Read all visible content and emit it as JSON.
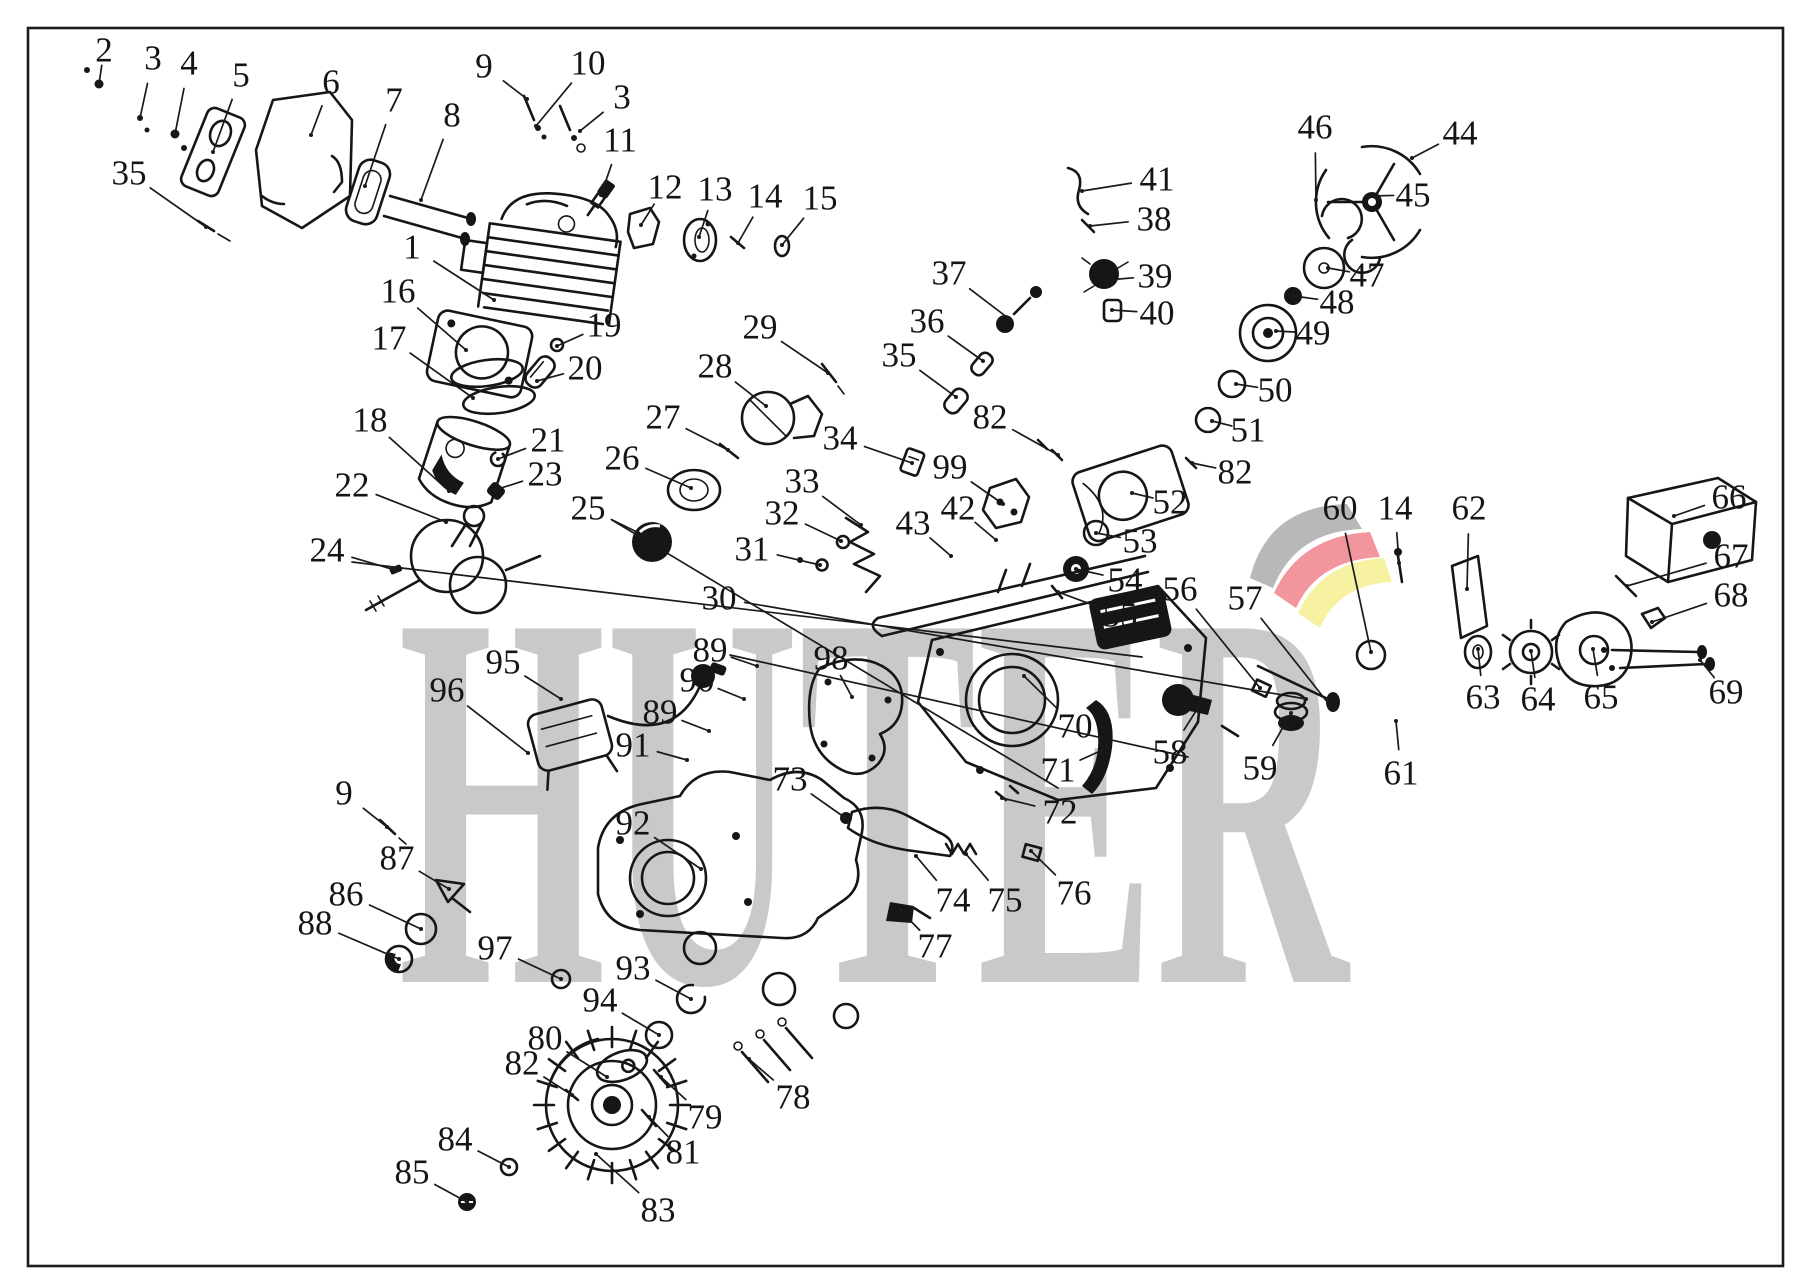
{
  "canvas": {
    "width": 1809,
    "height": 1283,
    "background": "#ffffff",
    "border_color": "#1c1c1c"
  },
  "watermark": {
    "text": "HUTER",
    "color": "#c9c9c9",
    "logo_colors": {
      "gray": "#b8b8b8",
      "red": "#f2959d",
      "yellow": "#f6f2a2"
    }
  },
  "extra_leader_lines": [
    [
      352,
      562,
      1142,
      657
    ],
    [
      612,
      520,
      1058,
      788
    ],
    [
      730,
      655,
      1188,
      757
    ]
  ],
  "callouts": [
    {
      "n": "2",
      "x": 104,
      "y": 50,
      "tx": 99,
      "ty": 84
    },
    {
      "n": "3",
      "x": 153,
      "y": 58,
      "tx": 140,
      "ty": 118
    },
    {
      "n": "4",
      "x": 189,
      "y": 63,
      "tx": 175,
      "ty": 134
    },
    {
      "n": "5",
      "x": 241,
      "y": 75,
      "tx": 213,
      "ty": 152
    },
    {
      "n": "6",
      "x": 331,
      "y": 82,
      "tx": 311,
      "ty": 135
    },
    {
      "n": "7",
      "x": 394,
      "y": 100,
      "tx": 365,
      "ty": 186
    },
    {
      "n": "8",
      "x": 452,
      "y": 115,
      "tx": 421,
      "ty": 200
    },
    {
      "n": "9",
      "x": 484,
      "y": 66,
      "tx": 527,
      "ty": 99
    },
    {
      "n": "10",
      "x": 588,
      "y": 63,
      "tx": 536,
      "ty": 126
    },
    {
      "n": "3",
      "x": 622,
      "y": 97,
      "tx": 580,
      "ty": 131
    },
    {
      "n": "35",
      "x": 129,
      "y": 173,
      "tx": 206,
      "ty": 227
    },
    {
      "n": "11",
      "x": 620,
      "y": 140,
      "tx": 601,
      "ty": 195
    },
    {
      "n": "12",
      "x": 665,
      "y": 187,
      "tx": 641,
      "ty": 225
    },
    {
      "n": "13",
      "x": 715,
      "y": 189,
      "tx": 699,
      "ty": 237
    },
    {
      "n": "14",
      "x": 765,
      "y": 196,
      "tx": 738,
      "ty": 243
    },
    {
      "n": "15",
      "x": 820,
      "y": 198,
      "tx": 782,
      "ty": 245
    },
    {
      "n": "1",
      "x": 412,
      "y": 247,
      "tx": 494,
      "ty": 300
    },
    {
      "n": "16",
      "x": 398,
      "y": 291,
      "tx": 466,
      "ty": 350
    },
    {
      "n": "17",
      "x": 389,
      "y": 338,
      "tx": 473,
      "ty": 398
    },
    {
      "n": "19",
      "x": 604,
      "y": 325,
      "tx": 557,
      "ty": 346
    },
    {
      "n": "20",
      "x": 585,
      "y": 368,
      "tx": 537,
      "ty": 381
    },
    {
      "n": "18",
      "x": 370,
      "y": 420,
      "tx": 449,
      "ty": 491
    },
    {
      "n": "21",
      "x": 548,
      "y": 440,
      "tx": 498,
      "ty": 459
    },
    {
      "n": "22",
      "x": 352,
      "y": 485,
      "tx": 446,
      "ty": 522
    },
    {
      "n": "23",
      "x": 545,
      "y": 474,
      "tx": 495,
      "ty": 490
    },
    {
      "n": "24",
      "x": 327,
      "y": 550,
      "tx": 395,
      "ty": 570
    },
    {
      "n": "25",
      "x": 588,
      "y": 508,
      "tx": 645,
      "ty": 536
    },
    {
      "n": "26",
      "x": 622,
      "y": 458,
      "tx": 691,
      "ty": 488
    },
    {
      "n": "27",
      "x": 663,
      "y": 417,
      "tx": 728,
      "ty": 450
    },
    {
      "n": "28",
      "x": 715,
      "y": 366,
      "tx": 766,
      "ty": 406
    },
    {
      "n": "29",
      "x": 760,
      "y": 327,
      "tx": 828,
      "ty": 373
    },
    {
      "n": "30",
      "x": 719,
      "y": 598,
      "tx": 1306,
      "ty": 699
    },
    {
      "n": "31",
      "x": 752,
      "y": 549,
      "tx": 820,
      "ty": 565
    },
    {
      "n": "32",
      "x": 782,
      "y": 513,
      "tx": 841,
      "ty": 541
    },
    {
      "n": "33",
      "x": 802,
      "y": 481,
      "tx": 861,
      "ty": 525
    },
    {
      "n": "34",
      "x": 840,
      "y": 438,
      "tx": 912,
      "ty": 463
    },
    {
      "n": "42",
      "x": 958,
      "y": 508,
      "tx": 996,
      "ty": 540
    },
    {
      "n": "43",
      "x": 913,
      "y": 523,
      "tx": 951,
      "ty": 556
    },
    {
      "n": "35",
      "x": 899,
      "y": 355,
      "tx": 956,
      "ty": 397
    },
    {
      "n": "36",
      "x": 927,
      "y": 321,
      "tx": 983,
      "ty": 361
    },
    {
      "n": "37",
      "x": 949,
      "y": 273,
      "tx": 1008,
      "ty": 318
    },
    {
      "n": "41",
      "x": 1157,
      "y": 179,
      "tx": 1082,
      "ty": 191
    },
    {
      "n": "38",
      "x": 1154,
      "y": 219,
      "tx": 1090,
      "ty": 226
    },
    {
      "n": "39",
      "x": 1155,
      "y": 276,
      "tx": 1107,
      "ty": 280
    },
    {
      "n": "40",
      "x": 1157,
      "y": 313,
      "tx": 1112,
      "ty": 310
    },
    {
      "n": "82",
      "x": 990,
      "y": 417,
      "tx": 1058,
      "ty": 455
    },
    {
      "n": "99",
      "x": 950,
      "y": 467,
      "tx": 1003,
      "ty": 504
    },
    {
      "n": "46",
      "x": 1315,
      "y": 127,
      "tx": 1316,
      "ty": 200
    },
    {
      "n": "44",
      "x": 1460,
      "y": 133,
      "tx": 1412,
      "ty": 158
    },
    {
      "n": "45",
      "x": 1413,
      "y": 195,
      "tx": 1370,
      "ty": 196
    },
    {
      "n": "47",
      "x": 1367,
      "y": 275,
      "tx": 1328,
      "ty": 268
    },
    {
      "n": "48",
      "x": 1337,
      "y": 302,
      "tx": 1294,
      "ty": 296
    },
    {
      "n": "49",
      "x": 1313,
      "y": 333,
      "tx": 1276,
      "ty": 331
    },
    {
      "n": "50",
      "x": 1275,
      "y": 390,
      "tx": 1236,
      "ty": 384
    },
    {
      "n": "51",
      "x": 1248,
      "y": 430,
      "tx": 1212,
      "ty": 421
    },
    {
      "n": "82",
      "x": 1235,
      "y": 472,
      "tx": 1192,
      "ty": 463
    },
    {
      "n": "52",
      "x": 1170,
      "y": 502,
      "tx": 1132,
      "ty": 493
    },
    {
      "n": "53",
      "x": 1140,
      "y": 541,
      "tx": 1096,
      "ty": 533
    },
    {
      "n": "54",
      "x": 1125,
      "y": 580,
      "tx": 1076,
      "ty": 569
    },
    {
      "n": "55",
      "x": 1120,
      "y": 615,
      "tx": 1058,
      "ty": 592
    },
    {
      "n": "56",
      "x": 1180,
      "y": 589,
      "tx": 1260,
      "ty": 688
    },
    {
      "n": "57",
      "x": 1245,
      "y": 598,
      "tx": 1328,
      "ty": 703
    },
    {
      "n": "60",
      "x": 1340,
      "y": 508,
      "tx": 1371,
      "ty": 652
    },
    {
      "n": "14",
      "x": 1395,
      "y": 508,
      "tx": 1399,
      "ty": 563
    },
    {
      "n": "62",
      "x": 1469,
      "y": 508,
      "tx": 1467,
      "ty": 589
    },
    {
      "n": "66",
      "x": 1729,
      "y": 497,
      "tx": 1674,
      "ty": 516
    },
    {
      "n": "67",
      "x": 1731,
      "y": 556,
      "tx": 1627,
      "ty": 586
    },
    {
      "n": "68",
      "x": 1731,
      "y": 595,
      "tx": 1652,
      "ty": 622
    },
    {
      "n": "69",
      "x": 1726,
      "y": 692,
      "tx": 1700,
      "ty": 660
    },
    {
      "n": "63",
      "x": 1483,
      "y": 697,
      "tx": 1478,
      "ty": 649
    },
    {
      "n": "64",
      "x": 1538,
      "y": 699,
      "tx": 1531,
      "ty": 651
    },
    {
      "n": "65",
      "x": 1601,
      "y": 697,
      "tx": 1593,
      "ty": 649
    },
    {
      "n": "58",
      "x": 1170,
      "y": 752,
      "tx": 1201,
      "ty": 703
    },
    {
      "n": "59",
      "x": 1260,
      "y": 768,
      "tx": 1291,
      "ty": 713
    },
    {
      "n": "61",
      "x": 1401,
      "y": 773,
      "tx": 1396,
      "ty": 721
    },
    {
      "n": "70",
      "x": 1075,
      "y": 726,
      "tx": 1024,
      "ty": 676
    },
    {
      "n": "71",
      "x": 1058,
      "y": 770,
      "tx": 1107,
      "ty": 748
    },
    {
      "n": "72",
      "x": 1060,
      "y": 812,
      "tx": 1002,
      "ty": 798
    },
    {
      "n": "89",
      "x": 710,
      "y": 650,
      "tx": 757,
      "ty": 666
    },
    {
      "n": "90",
      "x": 697,
      "y": 680,
      "tx": 744,
      "ty": 699
    },
    {
      "n": "89",
      "x": 660,
      "y": 712,
      "tx": 709,
      "ty": 731
    },
    {
      "n": "91",
      "x": 633,
      "y": 745,
      "tx": 687,
      "ty": 760
    },
    {
      "n": "98",
      "x": 831,
      "y": 658,
      "tx": 852,
      "ty": 697
    },
    {
      "n": "95",
      "x": 503,
      "y": 662,
      "tx": 561,
      "ty": 699
    },
    {
      "n": "96",
      "x": 447,
      "y": 690,
      "tx": 528,
      "ty": 753
    },
    {
      "n": "9",
      "x": 344,
      "y": 793,
      "tx": 387,
      "ty": 827
    },
    {
      "n": "73",
      "x": 790,
      "y": 779,
      "tx": 844,
      "ty": 817
    },
    {
      "n": "92",
      "x": 633,
      "y": 823,
      "tx": 701,
      "ty": 869
    },
    {
      "n": "87",
      "x": 397,
      "y": 858,
      "tx": 449,
      "ty": 889
    },
    {
      "n": "86",
      "x": 346,
      "y": 894,
      "tx": 421,
      "ty": 929
    },
    {
      "n": "88",
      "x": 315,
      "y": 923,
      "tx": 399,
      "ty": 959
    },
    {
      "n": "97",
      "x": 495,
      "y": 948,
      "tx": 561,
      "ty": 979
    },
    {
      "n": "93",
      "x": 633,
      "y": 968,
      "tx": 691,
      "ty": 999
    },
    {
      "n": "94",
      "x": 600,
      "y": 1000,
      "tx": 659,
      "ty": 1035
    },
    {
      "n": "74",
      "x": 953,
      "y": 900,
      "tx": 916,
      "ty": 856
    },
    {
      "n": "75",
      "x": 1005,
      "y": 900,
      "tx": 966,
      "ty": 854
    },
    {
      "n": "76",
      "x": 1074,
      "y": 893,
      "tx": 1031,
      "ty": 851
    },
    {
      "n": "77",
      "x": 935,
      "y": 946,
      "tx": 901,
      "ty": 911
    },
    {
      "n": "80",
      "x": 545,
      "y": 1038,
      "tx": 607,
      "ty": 1077
    },
    {
      "n": "82",
      "x": 522,
      "y": 1063,
      "tx": 572,
      "ty": 1095
    },
    {
      "n": "78",
      "x": 793,
      "y": 1097,
      "tx": 749,
      "ty": 1059
    },
    {
      "n": "79",
      "x": 705,
      "y": 1117,
      "tx": 661,
      "ty": 1077
    },
    {
      "n": "81",
      "x": 683,
      "y": 1152,
      "tx": 649,
      "ty": 1117
    },
    {
      "n": "84",
      "x": 455,
      "y": 1139,
      "tx": 509,
      "ty": 1167
    },
    {
      "n": "85",
      "x": 412,
      "y": 1172,
      "tx": 467,
      "ty": 1202
    },
    {
      "n": "83",
      "x": 658,
      "y": 1210,
      "tx": 596,
      "ty": 1154
    }
  ]
}
